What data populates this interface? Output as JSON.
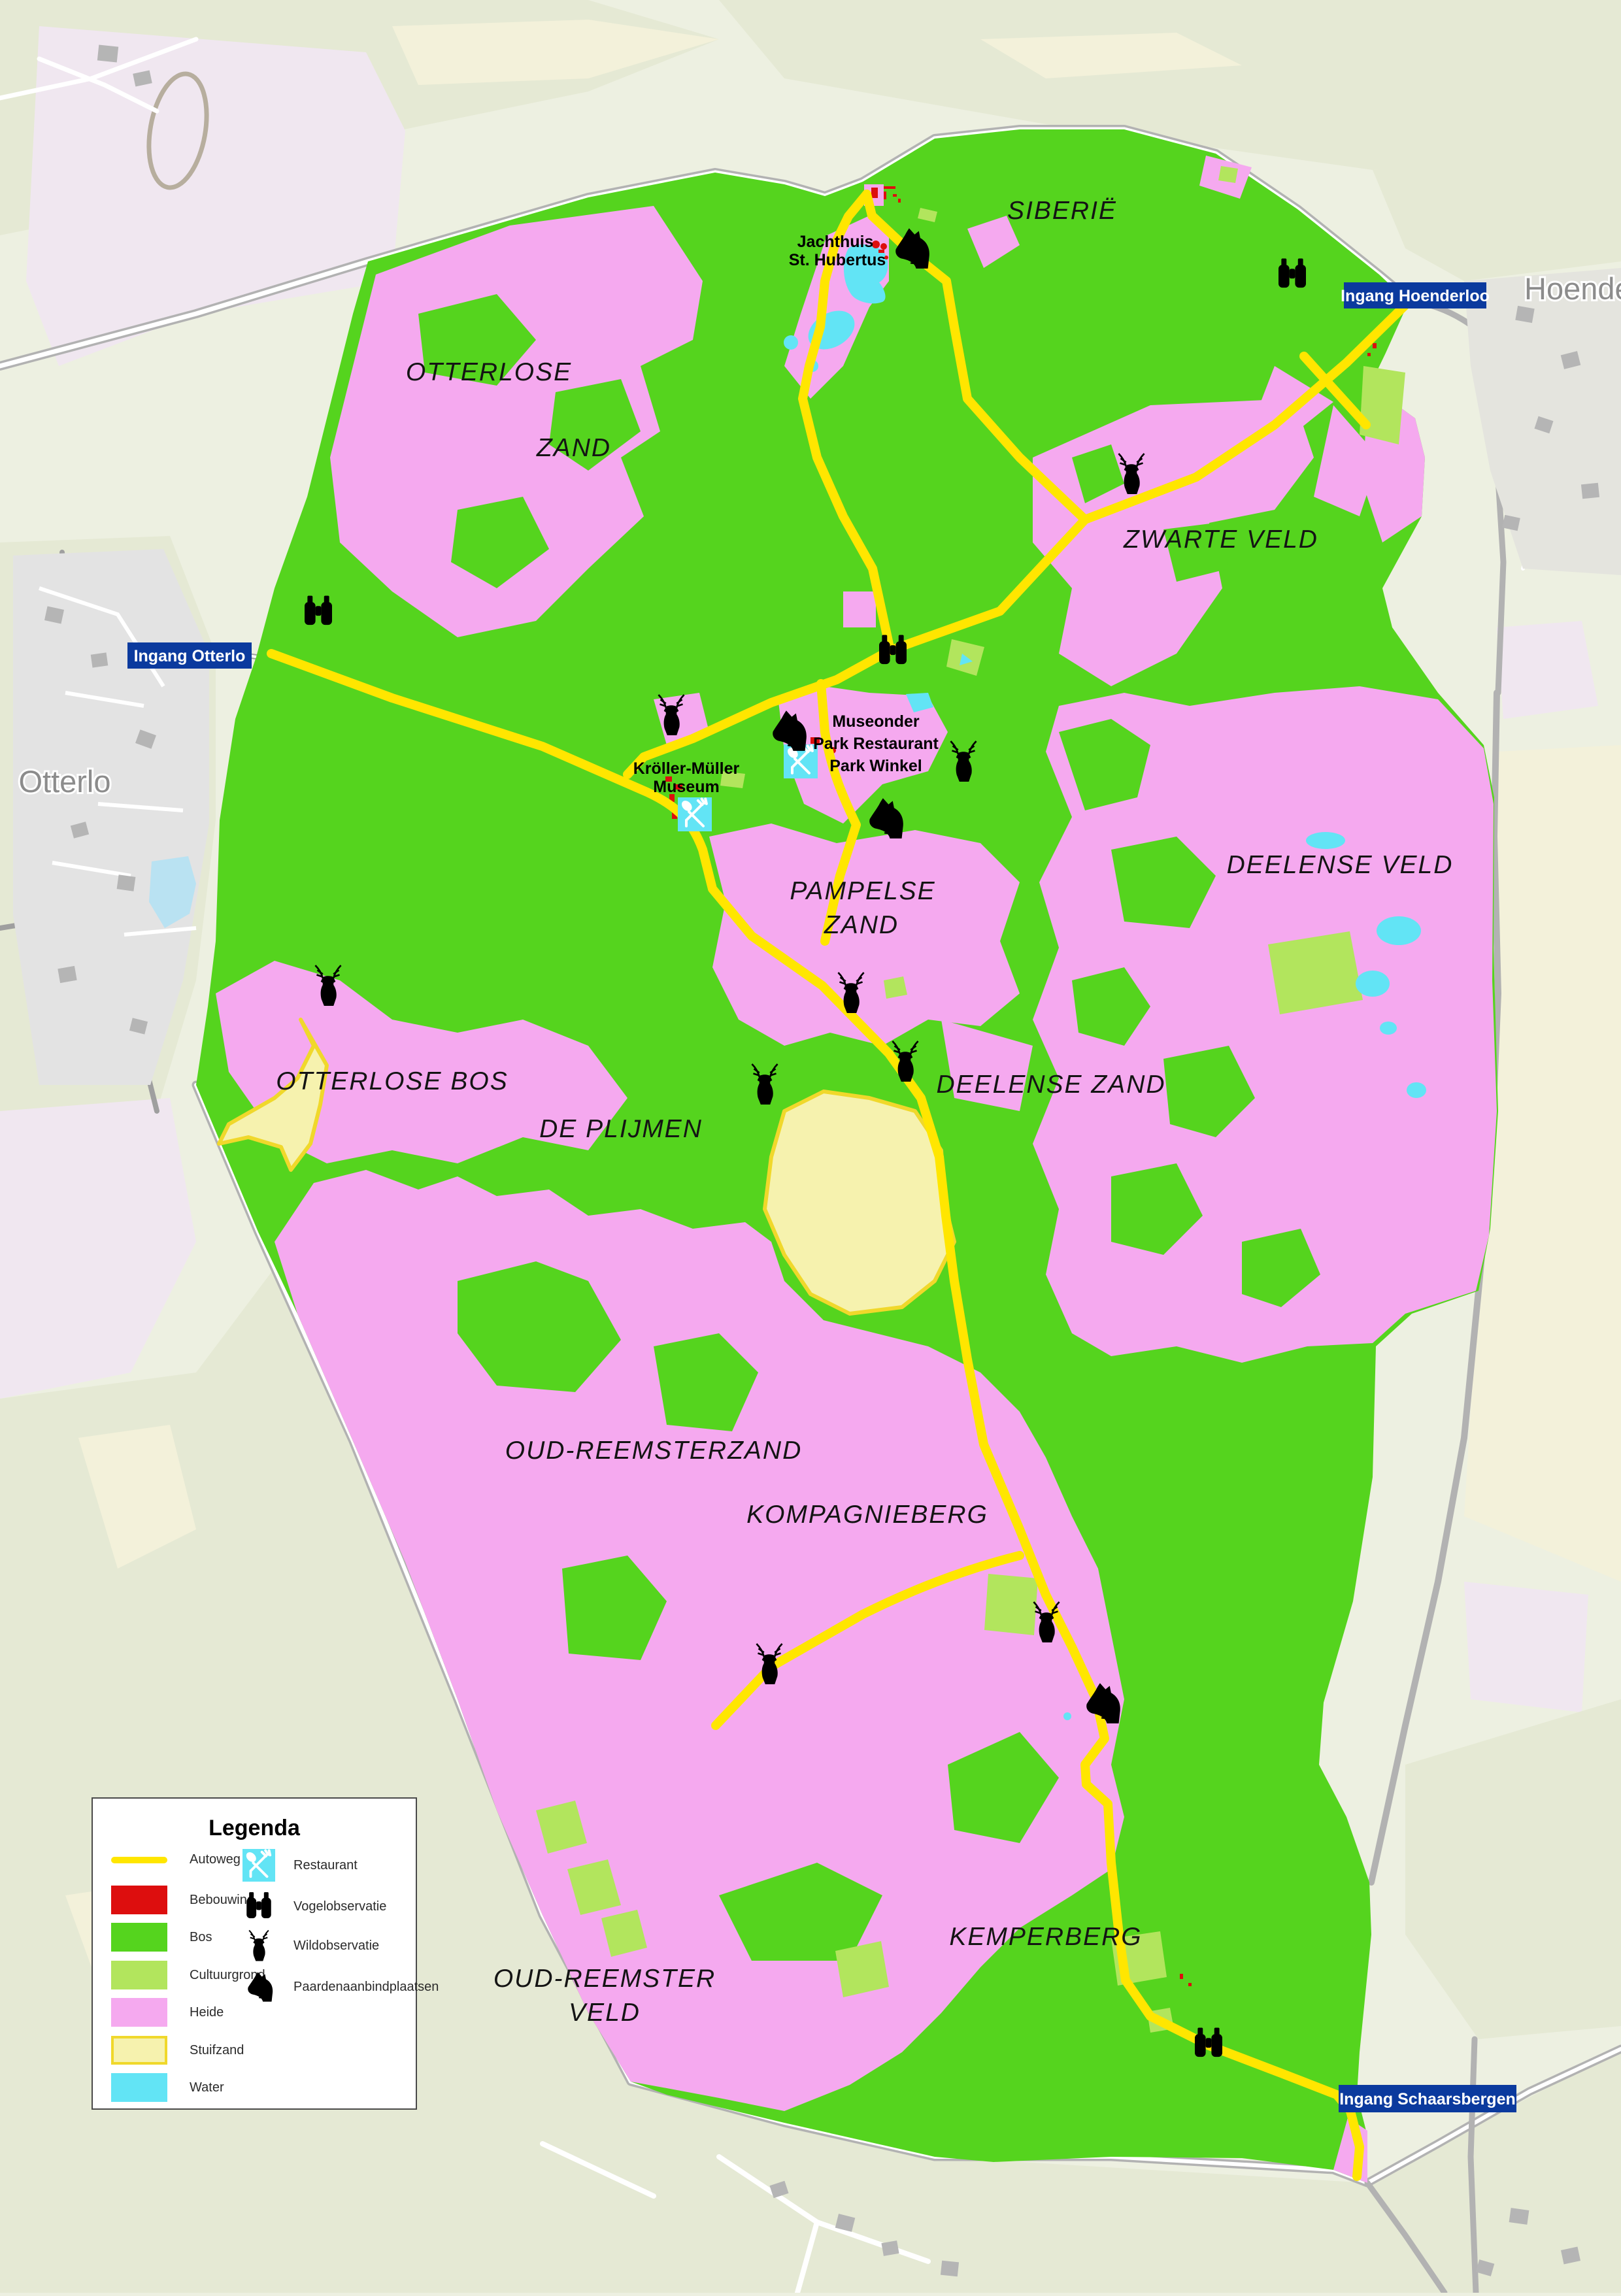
{
  "colors": {
    "bos": "#55d41e",
    "cultuurgrond": "#b2e55d",
    "heide": "#f5a9ef",
    "stuifzand": "#f6f2ae",
    "stuifzand_border": "#f0d82b",
    "water": "#62e4f5",
    "bebouwing": "#dd0e0e",
    "autoweg": "#ffe600",
    "badge": "#0b3a9e",
    "badge_text": "#ffffff",
    "label": "#141414",
    "town_label": "#8c8c8c",
    "outside": "#edf0e1",
    "outside_field": "#e5e9d4",
    "outside_cream": "#f3f1da",
    "outside_lavender": "#f0e7f0",
    "town_block": "#e3e3e3",
    "town_building": "#b5b5b5",
    "road_gray": "#b2b2b2",
    "road_white": "#ffffff",
    "icon": "#000000"
  },
  "legend": {
    "title": "Legenda",
    "left": [
      {
        "key": "autoweg",
        "label": "Autoweg"
      },
      {
        "key": "bebouwing",
        "label": "Bebouwing"
      },
      {
        "key": "bos",
        "label": "Bos"
      },
      {
        "key": "cultuurgrond",
        "label": "Cultuurgrond"
      },
      {
        "key": "heide",
        "label": "Heide"
      },
      {
        "key": "stuifzand",
        "label": "Stuifzand"
      },
      {
        "key": "water",
        "label": "Water"
      }
    ],
    "right": [
      {
        "key": "restaurant",
        "label": "Restaurant"
      },
      {
        "key": "vogelobservatie",
        "label": "Vogelobservatie"
      },
      {
        "key": "wildobservatie",
        "label": "Wildobservatie"
      },
      {
        "key": "paardenaanbindplaatsen",
        "label": "Paardenaanbindplaatsen"
      }
    ]
  },
  "badges": {
    "otterlo": "Ingang Otterlo",
    "hoenderloo": "Ingang Hoenderloo",
    "schaarsbergen": "Ingang Schaarsbergen"
  },
  "towns": {
    "otterlo": "Otterlo",
    "hoenderloo": "Hoenderloo"
  },
  "regions": {
    "siberie": "SIBERIË",
    "otterlose_line1": "OTTERLOSE",
    "otterlose_line2": "ZAND",
    "zwarte_veld": "ZWARTE VELD",
    "deelense_veld": "DEELENSE VELD",
    "pampelse_line1": "PAMPELSE",
    "pampelse_line2": "ZAND",
    "otterlose_bos": "OTTERLOSE BOS",
    "de_plijmen": "DE PLIJMEN",
    "deelense_zand": "DEELENSE ZAND",
    "oud_reemsterzand": "OUD-REEMSTERZAND",
    "kompagnieberg": "KOMPAGNIEBERG",
    "oud_reemster_line1": "OUD-REEMSTER",
    "oud_reemster_line2": "VELD",
    "kemperberg": "KEMPERBERG"
  },
  "pois": {
    "jachthuis_line1": "Jachthuis",
    "jachthuis_line2": "St. Hubertus",
    "museonder": "Museonder",
    "park_restaurant": "Park Restaurant",
    "park_winkel": "Park Winkel",
    "kroller_line1": "Kröller-Müller",
    "kroller_line2": "Museum"
  },
  "icons": {
    "restaurant": "restaurant-icon",
    "vogelobservatie": "binoculars-icon",
    "wildobservatie": "deer-icon",
    "paardenaanbindplaatsen": "horse-icon"
  }
}
